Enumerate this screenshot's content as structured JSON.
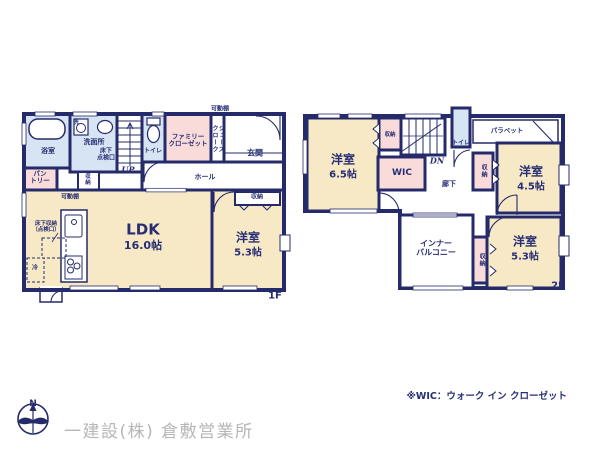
{
  "f1": {
    "floor_label": "1F",
    "shelf_top": "可動棚",
    "bath": "浴室",
    "laundry": "洗",
    "washroom": "洗面所",
    "inspection": "床下\n点検口",
    "stairs_up": "UP",
    "toilet": "トイレ",
    "family_closet": "ファミリー\nクローゼット",
    "shoes_closet": "シューズクローク",
    "entrance": "玄関",
    "pantry": "パン\nトリー",
    "stair_storage": "収\n納",
    "hall": "ホール",
    "shelf_ldk": "可動棚",
    "ldk": "LDK",
    "ldk_size": "16.0帖",
    "floor_storage": "床下収納\n（点検口）",
    "fridge": "冷",
    "bedroom_storage": "収納",
    "bedroom": "洋室",
    "bedroom_size": "5.3帖"
  },
  "f2": {
    "floor_label": "2F",
    "bedroom1": "洋室",
    "bedroom1_size": "6.5帖",
    "storage1": "収納",
    "stairs_dn": "DN",
    "toilet": "トイレ",
    "parapet": "パラペット",
    "wic": "WIC",
    "corridor": "廊下",
    "storage2": "収納",
    "bedroom2": "洋室",
    "bedroom2_size": "4.5帖",
    "inner_balcony": "インナー\nバルコニー",
    "storage3": "収納",
    "bedroom3": "洋室",
    "bedroom3_size": "5.3帖"
  },
  "footer": {
    "compass_n": "N",
    "company": "一建設(株) 倉敷営業所",
    "note": "※WIC：ウォーク イン クローゼット"
  },
  "colors": {
    "wall_navy": "#252b6a",
    "text_navy": "#272e74",
    "room_cream": "#f7e9c6",
    "closet_pink": "#f9dcd9",
    "water_blue": "#d7e4f3",
    "company_gray": "#b6b6b8"
  }
}
